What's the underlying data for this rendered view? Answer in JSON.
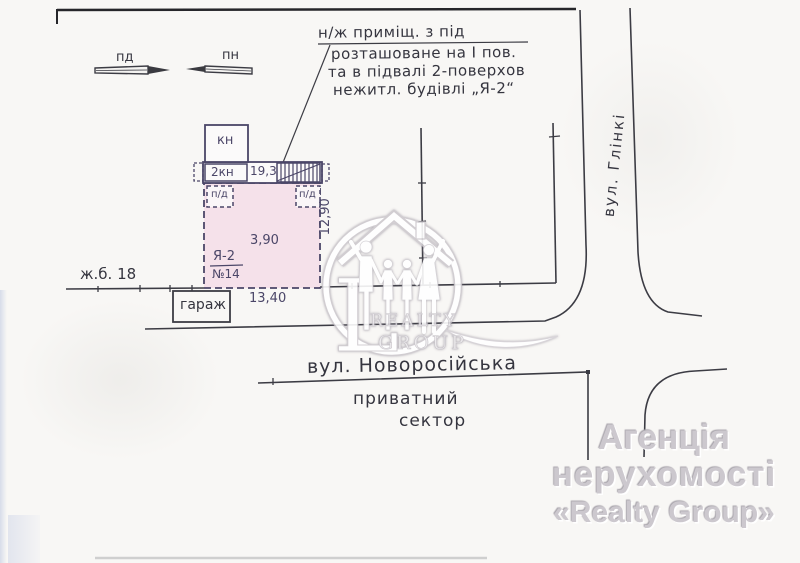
{
  "annotation": {
    "line1": "н/ж приміщ. з під",
    "line2": "розташоване на І пов.",
    "line3": "та в підвалі 2-поверхов",
    "line4": "нежитл. будівлі „Я-2“"
  },
  "compass": {
    "south_label": "пд",
    "north_label": "пн"
  },
  "plan": {
    "kn_label": "кн",
    "kn2_label": "2кн",
    "strip_dim": "19,3",
    "basement_left_label": "п/д",
    "basement_right_label": "п/д",
    "litera_label": "Я-2",
    "number_label": "№14",
    "inner_dim": "3,90",
    "width_dim": "13,40",
    "depth_dim": "12,90",
    "garage_label": "гараж",
    "neighbor_house_label": "ж.б. 18"
  },
  "streets": {
    "vertical_street": "вул. Глінкі",
    "horizontal_street": "вул. Новоросійська",
    "sector_line1": "приватний",
    "sector_line2": "сектор"
  },
  "watermark": {
    "monogram": "L",
    "word1": "REALTY",
    "word2": "GROUP"
  },
  "agency": {
    "line1": "Агенція",
    "line2": "нерухомості",
    "line3": "«Realty Group»"
  },
  "colors": {
    "ink": "#38383f",
    "blue_ink": "#4b4668",
    "building_fill": "#f5e1ea",
    "watermark": "#ffffff",
    "agency_text": "#ccc8ce"
  }
}
